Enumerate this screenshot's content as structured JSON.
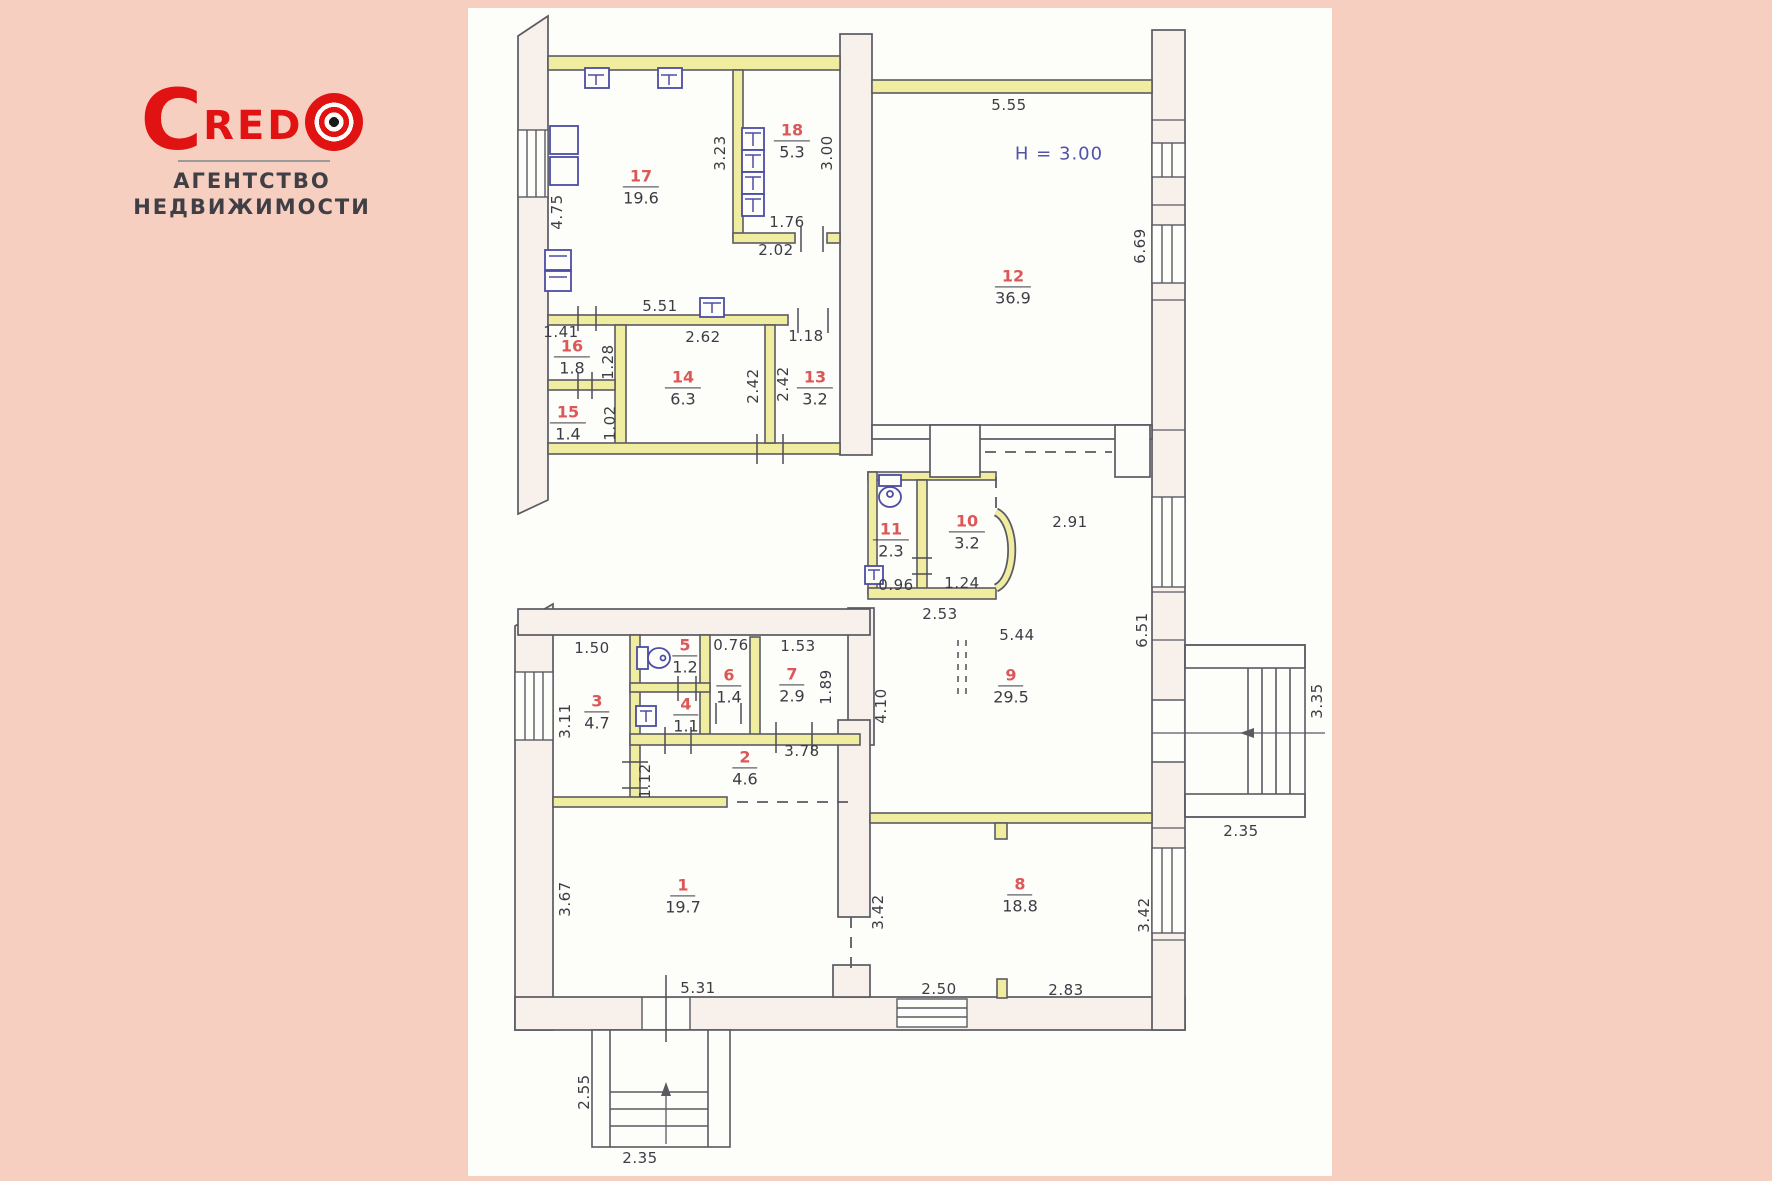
{
  "logo": {
    "brand_c": "C",
    "brand_red": "RED",
    "mark_icon": "bullseye-target-icon",
    "sub1": "АГЕНТСТВО",
    "sub2": "НЕДВИЖИМОСТИ"
  },
  "plan": {
    "height_label": "H = 3.00",
    "rooms": [
      {
        "n": "1",
        "a": "19.7"
      },
      {
        "n": "2",
        "a": "4.6"
      },
      {
        "n": "3",
        "a": "4.7"
      },
      {
        "n": "4",
        "a": "1.1"
      },
      {
        "n": "5",
        "a": "1.2"
      },
      {
        "n": "6",
        "a": "1.4"
      },
      {
        "n": "7",
        "a": "2.9"
      },
      {
        "n": "8",
        "a": "18.8"
      },
      {
        "n": "9",
        "a": "29.5"
      },
      {
        "n": "10",
        "a": "3.2"
      },
      {
        "n": "11",
        "a": "2.3"
      },
      {
        "n": "12",
        "a": "36.9"
      },
      {
        "n": "13",
        "a": "3.2"
      },
      {
        "n": "14",
        "a": "6.3"
      },
      {
        "n": "15",
        "a": "1.4"
      },
      {
        "n": "16",
        "a": "1.8"
      },
      {
        "n": "17",
        "a": "19.6"
      },
      {
        "n": "18",
        "a": "5.3"
      }
    ],
    "dims": [
      {
        "v": "4.75"
      },
      {
        "v": "3.23"
      },
      {
        "v": "3.00"
      },
      {
        "v": "5.55"
      },
      {
        "v": "1.76"
      },
      {
        "v": "2.02"
      },
      {
        "v": "6.69"
      },
      {
        "v": "1.41"
      },
      {
        "v": "5.51"
      },
      {
        "v": "2.62"
      },
      {
        "v": "1.28"
      },
      {
        "v": "2.42"
      },
      {
        "v": "2.42"
      },
      {
        "v": "1.18"
      },
      {
        "v": "1.02"
      },
      {
        "v": "0.96"
      },
      {
        "v": "1.24"
      },
      {
        "v": "2.53"
      },
      {
        "v": "2.91"
      },
      {
        "v": "5.44"
      },
      {
        "v": "6.51"
      },
      {
        "v": "4.10"
      },
      {
        "v": "1.50"
      },
      {
        "v": "3.11"
      },
      {
        "v": "0.76"
      },
      {
        "v": "1.53"
      },
      {
        "v": "1.89"
      },
      {
        "v": "3.78"
      },
      {
        "v": "1.12"
      },
      {
        "v": "3.67"
      },
      {
        "v": "5.31"
      },
      {
        "v": "2.50"
      },
      {
        "v": "2.83"
      },
      {
        "v": "3.42"
      },
      {
        "v": "3.42"
      },
      {
        "v": "2.55"
      },
      {
        "v": "2.35"
      },
      {
        "v": "3.35"
      },
      {
        "v": "2.35"
      }
    ],
    "colors": {
      "page_bg": "#f7cfc0",
      "paper": "#fdfdfa",
      "pencil": "#5a5a63",
      "wall_fill_pink": "#f8f0eb",
      "wall_fill_yellow": "#f0eda1",
      "room_number_red": "#dc5858",
      "fixture_blue": "#4d4da6",
      "height_note_blue": "#5252aa",
      "brand_red": "#e01212"
    }
  }
}
